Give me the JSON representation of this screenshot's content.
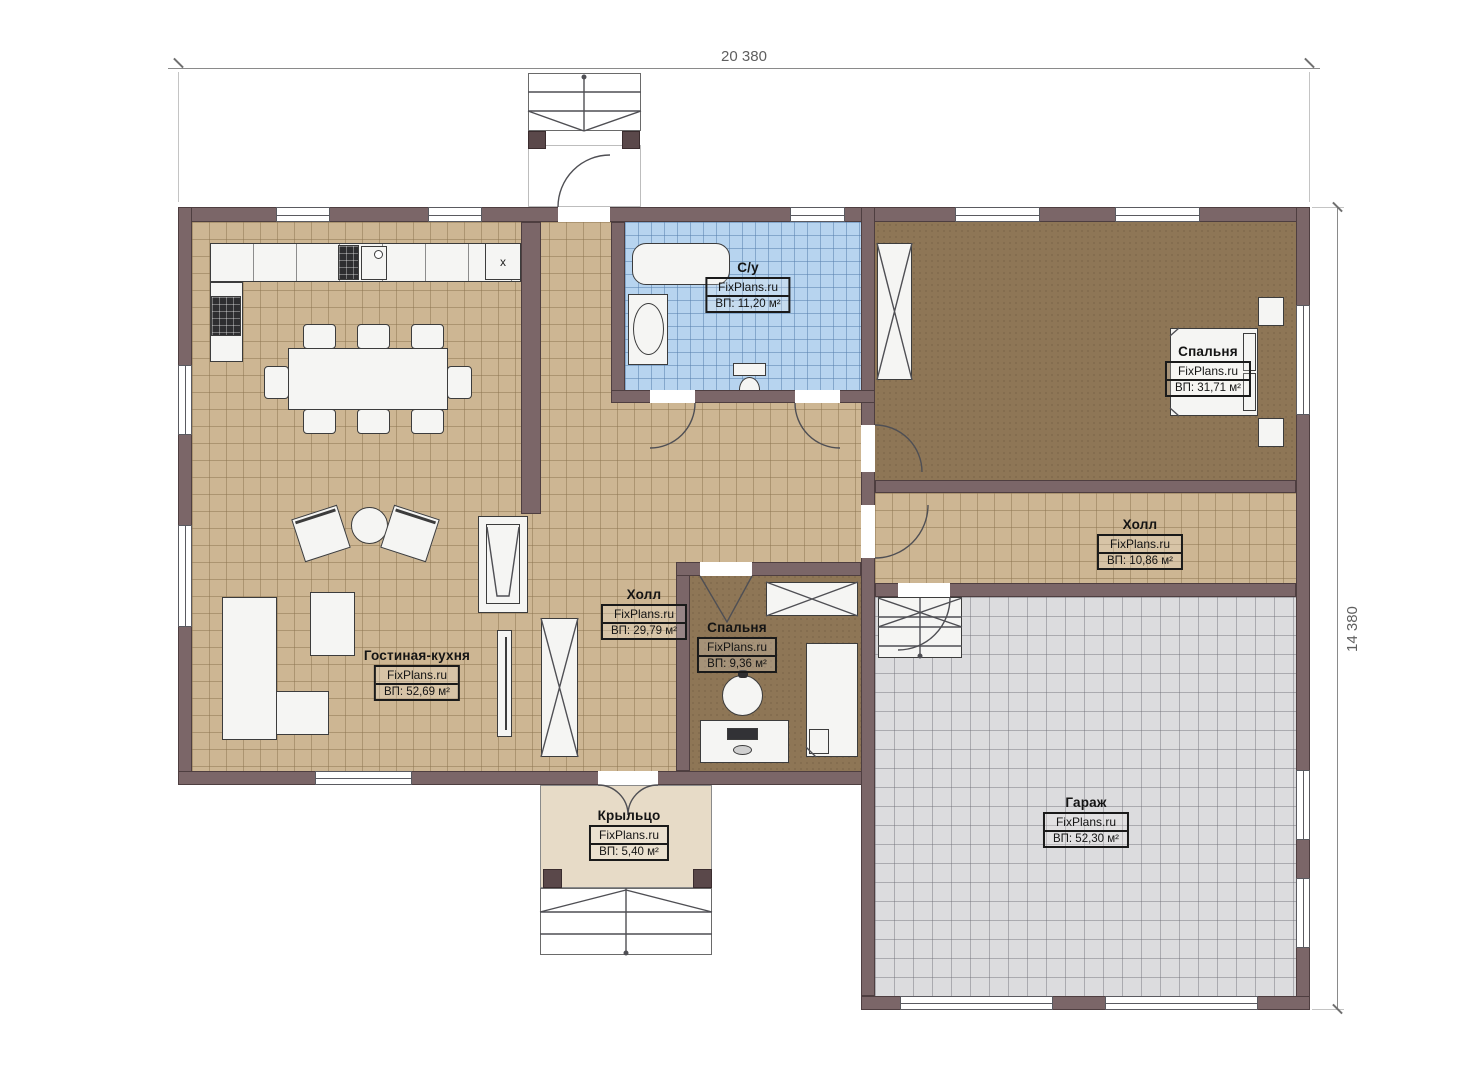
{
  "meta": {
    "type": "floor-plan"
  },
  "branding": "FixPlans.ru",
  "dimensions": {
    "width_label": "20 380",
    "height_label": "14 380"
  },
  "kitchen": {
    "cabinet_mark": "x"
  },
  "colors": {
    "wall": "#7b6668",
    "floor_wood": "#cdb693",
    "floor_bath": "#b7d4ef",
    "floor_bedroom": "#8e7656",
    "floor_garage": "#dcdcde",
    "floor_porch": "#e7dbc7"
  },
  "rooms": [
    {
      "id": "living-kitchen",
      "name": "Гостиная-кухня",
      "area": "ВП: 52,69 м²"
    },
    {
      "id": "hall-main",
      "name": "Холл",
      "area": "ВП: 29,79 м²"
    },
    {
      "id": "bathroom",
      "name": "С/у",
      "area": "ВП: 11,20 м²"
    },
    {
      "id": "bedroom-main",
      "name": "Спальня",
      "area": "ВП: 31,71 м²"
    },
    {
      "id": "hall-right",
      "name": "Холл",
      "area": "ВП: 10,86 м²"
    },
    {
      "id": "bedroom-small",
      "name": "Спальня",
      "area": "ВП: 9,36 м²"
    },
    {
      "id": "garage",
      "name": "Гараж",
      "area": "ВП: 52,30 м²"
    },
    {
      "id": "porch",
      "name": "Крыльцо",
      "area": "ВП: 5,40 м²"
    }
  ]
}
